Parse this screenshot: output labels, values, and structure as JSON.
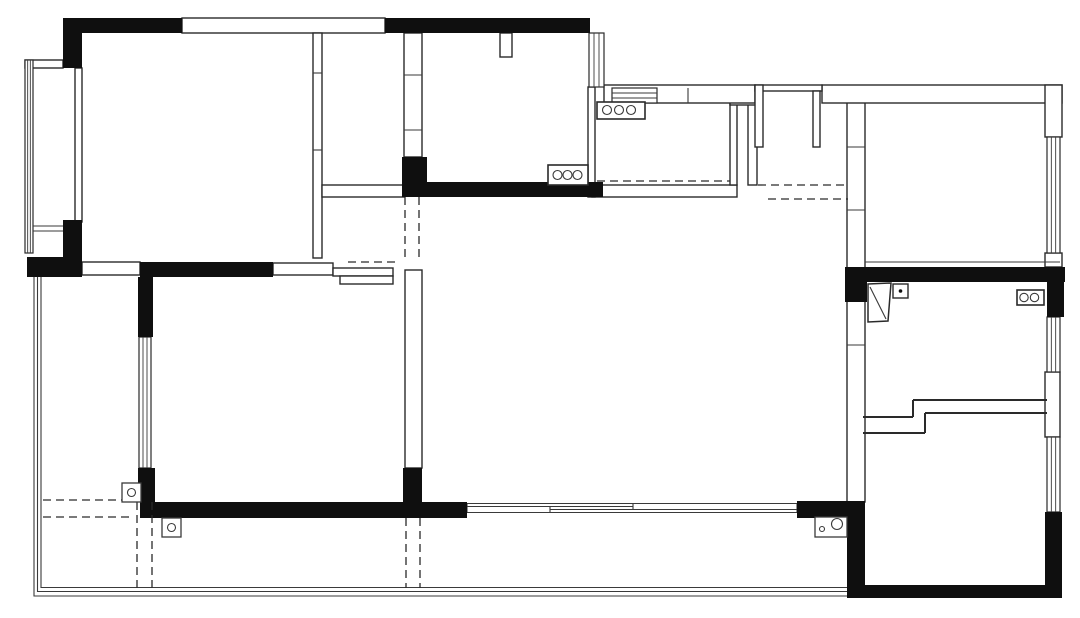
{
  "canvas": {
    "width": 1080,
    "height": 618,
    "background": "#ffffff"
  },
  "colors": {
    "structural_wall": "#0f0f0f",
    "partition_stroke": "#2a2a2a",
    "thin_line": "#3a3a3a",
    "dashed_line": "#2a2a2a",
    "fill_white": "#ffffff"
  },
  "plan": {
    "structural_walls": [
      [
        63,
        18,
        119,
        15
      ],
      [
        63,
        18,
        19,
        50
      ],
      [
        385,
        18,
        205,
        15
      ],
      [
        63,
        220,
        19,
        37
      ],
      [
        27,
        257,
        55,
        20
      ],
      [
        140,
        262,
        133,
        15
      ],
      [
        138,
        277,
        15,
        60
      ],
      [
        138,
        468,
        17,
        34
      ],
      [
        140,
        502,
        327,
        16
      ],
      [
        403,
        468,
        19,
        34
      ],
      [
        402,
        157,
        25,
        40
      ],
      [
        402,
        182,
        201,
        15
      ],
      [
        797,
        501,
        68,
        17
      ],
      [
        845,
        267,
        220,
        15
      ],
      [
        1047,
        282,
        17,
        35
      ],
      [
        845,
        282,
        22,
        20
      ],
      [
        847,
        502,
        18,
        96
      ],
      [
        847,
        585,
        215,
        13
      ],
      [
        1045,
        512,
        17,
        86
      ]
    ],
    "partition_walls": [
      [
        182,
        18,
        203,
        15
      ],
      [
        75,
        68,
        7,
        154
      ],
      [
        313,
        33,
        9,
        225
      ],
      [
        404,
        33,
        18,
        124
      ],
      [
        588,
        87,
        7,
        110
      ],
      [
        322,
        185,
        82,
        12
      ],
      [
        592,
        185,
        145,
        12
      ],
      [
        730,
        103,
        7,
        82
      ],
      [
        748,
        100,
        9,
        85
      ],
      [
        730,
        97,
        27,
        8
      ],
      [
        82,
        262,
        58,
        13
      ],
      [
        273,
        263,
        60,
        12
      ],
      [
        333,
        268,
        60,
        8
      ],
      [
        340,
        276,
        53,
        8
      ],
      [
        405,
        270,
        17,
        198
      ],
      [
        847,
        100,
        18,
        402
      ],
      [
        604,
        85,
        151,
        18
      ],
      [
        822,
        85,
        240,
        18
      ],
      [
        755,
        85,
        67,
        6
      ],
      [
        755,
        85,
        8,
        62
      ],
      [
        813,
        91,
        7,
        56
      ],
      [
        1045,
        85,
        17,
        52
      ],
      [
        1045,
        372,
        15,
        65
      ],
      [
        500,
        33,
        12,
        24
      ],
      [
        25,
        60,
        38,
        8
      ],
      [
        1045,
        253,
        17,
        14
      ]
    ],
    "windows": [
      {
        "rect": [
          25,
          60,
          8,
          193
        ],
        "dir": "v",
        "inner": 2
      },
      {
        "rect": [
          139,
          337,
          12,
          131
        ],
        "dir": "v",
        "inner": 2
      },
      {
        "rect": [
          589,
          33,
          15,
          54
        ],
        "dir": "v",
        "inner": 2
      },
      {
        "rect": [
          612,
          88,
          45,
          15
        ],
        "dir": "h",
        "inner": 2
      },
      {
        "rect": [
          1047,
          137,
          13,
          116
        ],
        "dir": "v",
        "inner": 2
      },
      {
        "rect": [
          1047,
          317,
          13,
          55
        ],
        "dir": "v",
        "inner": 2
      },
      {
        "rect": [
          1047,
          437,
          13,
          75
        ],
        "dir": "v",
        "inner": 2
      }
    ],
    "terrace_outline_polylines": [
      [
        [
          34,
          277
        ],
        [
          34,
          596
        ],
        [
          848,
          596
        ]
      ],
      [
        [
          37.5,
          277
        ],
        [
          37.5,
          591.5
        ],
        [
          848,
          591.5
        ]
      ],
      [
        [
          41,
          277
        ],
        [
          41,
          587.5
        ],
        [
          848,
          587.5
        ]
      ]
    ],
    "thin_lines": [
      [
        467,
        503.5,
        797,
        503.5
      ],
      [
        467,
        512.5,
        797,
        512.5
      ],
      [
        467,
        506.5,
        633,
        506.5
      ],
      [
        550,
        509.5,
        797,
        509.5
      ],
      [
        633,
        503.5,
        633,
        509.5
      ],
      [
        550,
        506.5,
        550,
        512.5
      ],
      [
        467,
        503.5,
        467,
        512.5
      ],
      [
        797,
        503.5,
        797,
        512.5
      ],
      [
        33,
        226,
        63,
        226
      ],
      [
        33,
        231,
        63,
        231
      ],
      [
        865,
        262,
        1060,
        262
      ],
      [
        313,
        73,
        322,
        73
      ],
      [
        313,
        150,
        322,
        150
      ],
      [
        404,
        75,
        422,
        75
      ],
      [
        404,
        130,
        422,
        130
      ],
      [
        847,
        147,
        865,
        147
      ],
      [
        847,
        210,
        865,
        210
      ],
      [
        847,
        345,
        865,
        345
      ],
      [
        688,
        88,
        688,
        103
      ]
    ],
    "step_wall_lines": [
      [
        863,
        417,
        913,
        417
      ],
      [
        913,
        417,
        913,
        400
      ],
      [
        913,
        400,
        1047,
        400
      ],
      [
        863,
        433,
        925,
        433
      ],
      [
        925,
        433,
        925,
        413
      ],
      [
        925,
        413,
        1047,
        413
      ]
    ],
    "dashed_lines": [
      [
        597,
        181,
        730,
        181
      ],
      [
        758,
        185,
        848,
        185
      ],
      [
        768,
        199,
        848,
        199
      ],
      [
        405,
        197,
        405,
        258
      ],
      [
        419,
        197,
        419,
        258
      ],
      [
        348,
        262,
        398,
        262
      ],
      [
        137,
        502,
        137,
        588
      ],
      [
        152,
        502,
        152,
        588
      ],
      [
        406,
        518,
        406,
        588
      ],
      [
        420,
        518,
        420,
        588
      ],
      [
        43,
        500,
        133,
        500
      ],
      [
        43,
        517,
        133,
        517
      ]
    ],
    "fixtures": {
      "burner_boxes": [
        {
          "box": [
            548,
            165,
            40,
            20
          ],
          "cy": 175,
          "cx": [
            557.5,
            567.5,
            577.5
          ],
          "r": 4.5
        },
        {
          "box": [
            597,
            102,
            48,
            17
          ],
          "cy": 110,
          "cx": [
            607,
            619,
            631
          ],
          "r": 4.5
        }
      ],
      "double_sink": {
        "box": [
          1017,
          290,
          27,
          15
        ],
        "cy": 297.5,
        "cx": [
          1024,
          1034.5
        ],
        "r": 4.2
      },
      "floor_drains": [
        {
          "box": [
            122,
            483,
            19,
            19
          ],
          "c": [
            131.5,
            492.5
          ],
          "r": 4
        },
        {
          "box": [
            162,
            518,
            19,
            19
          ],
          "c": [
            171.5,
            527.5
          ],
          "r": 4
        }
      ],
      "meter_box": {
        "box": [
          893,
          284,
          15,
          14
        ],
        "c": [
          900.5,
          291
        ],
        "r": 1.8
      },
      "drain_unit": {
        "box": [
          815,
          517,
          32,
          20
        ],
        "circles": [
          [
            822,
            529,
            2.5
          ],
          [
            837,
            524,
            5.5
          ]
        ]
      },
      "door_leaf": {
        "poly": [
          [
            868,
            284
          ],
          [
            891,
            283
          ],
          [
            888,
            321
          ],
          [
            868,
            322
          ]
        ],
        "line": [
          870,
          287,
          886,
          319
        ]
      }
    }
  }
}
